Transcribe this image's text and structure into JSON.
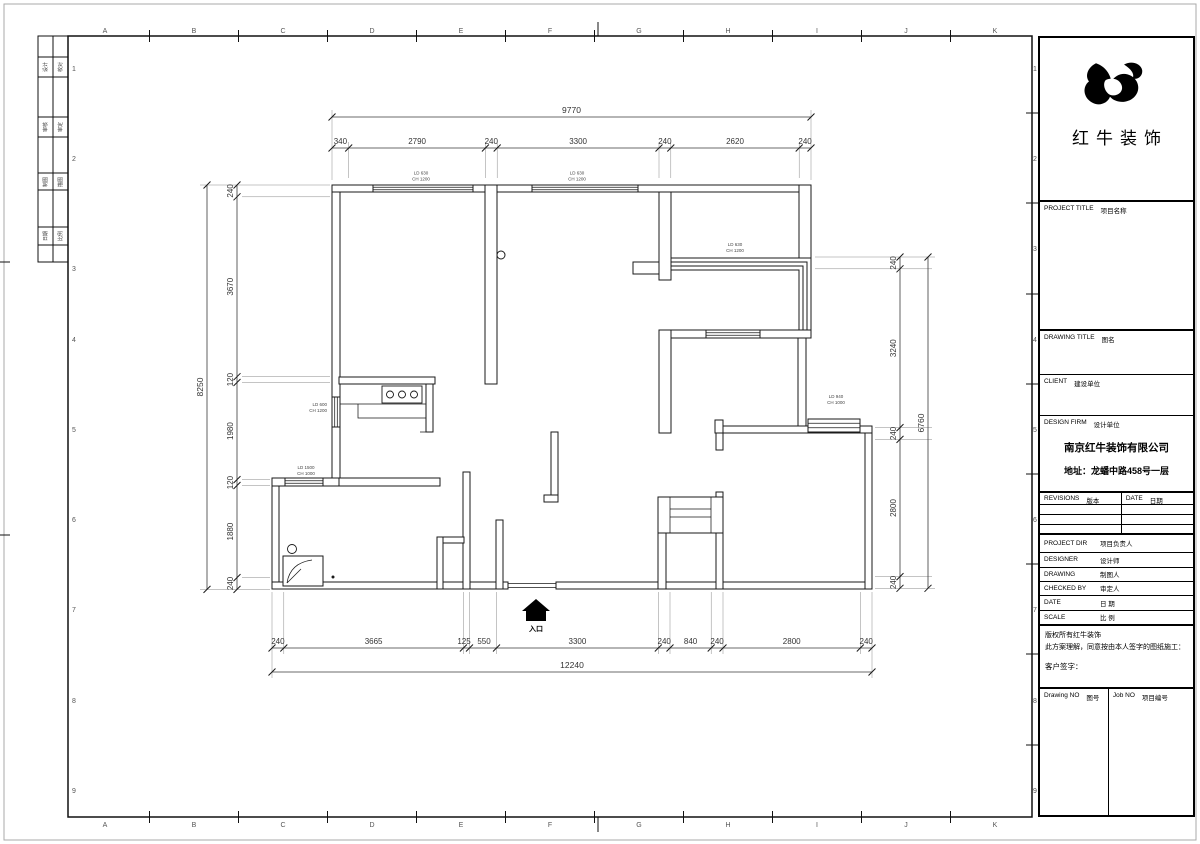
{
  "company": {
    "name": "红牛装饰"
  },
  "grid": {
    "cols": [
      "A",
      "B",
      "C",
      "D",
      "E",
      "F",
      "G",
      "H",
      "I",
      "J",
      "K"
    ],
    "rows": [
      "1",
      "2",
      "3",
      "4",
      "5",
      "6",
      "7",
      "8",
      "9"
    ]
  },
  "signoff": [
    "设计",
    "校对",
    "审核",
    "审定",
    "制图",
    "描图",
    "日期",
    "比例"
  ],
  "plan": {
    "dims": {
      "top": {
        "total": "9770",
        "segments": [
          "340",
          "2790",
          "240",
          "3300",
          "240",
          "2620",
          "240"
        ]
      },
      "bottom": {
        "total": "12240",
        "segments": [
          "240",
          "3665",
          "125",
          "550",
          "3300",
          "240",
          "840",
          "240",
          "2800",
          "240"
        ]
      },
      "left": {
        "total": "8250",
        "segments": [
          "240",
          "3670",
          "120",
          "1980",
          "120",
          "1880",
          "240"
        ]
      },
      "right": {
        "total": "6760",
        "segments": [
          "240",
          "3240",
          "240",
          "2800",
          "240"
        ]
      }
    },
    "windows": [
      {
        "l1": "LD 630",
        "l2": "CH 1200"
      },
      {
        "l1": "LD 630",
        "l2": "CH 1200"
      },
      {
        "l1": "LD 630",
        "l2": "CH 1200"
      },
      {
        "l1": "LD 940",
        "l2": "CH 1000"
      },
      {
        "l1": "LD 600",
        "l2": "CH 1200"
      },
      {
        "l1": "LD 1500",
        "l2": "CH 1000"
      }
    ],
    "entrance_label": "入口"
  },
  "title_block": {
    "project_title": {
      "en": "PROJECT TITLE",
      "zh": "项目名称"
    },
    "drawing_title": {
      "en": "DRAWING TITLE",
      "zh": "图名"
    },
    "client": {
      "en": "CLIENT",
      "zh": "建设单位"
    },
    "design_firm": {
      "en": "DESIGN FIRM",
      "zh": "设计单位"
    },
    "firm_name": "南京红牛装饰有限公司",
    "firm_address": "地址：龙蟠中路458号一层",
    "revisions": {
      "en": "REVISIONS",
      "zh": "版本"
    },
    "rev_date": {
      "en": "DATE",
      "zh": "日期"
    },
    "project_dir": {
      "en": "PROJECT DIR",
      "zh": "项目负责人"
    },
    "designer": {
      "en": "DESIGNER",
      "zh": "设计师"
    },
    "drawing": {
      "en": "DRAWING",
      "zh": "制图人"
    },
    "checked_by": {
      "en": "CHECKED BY",
      "zh": "审定人"
    },
    "date": {
      "en": "DATE",
      "zh": "日  期"
    },
    "scale": {
      "en": "SCALE",
      "zh": "比  例"
    },
    "copyright1": "版权所有红牛装饰",
    "copyright2": "此方案理解，同意按由本人签字的图纸施工：",
    "signature": "客户签字：",
    "drawing_no": {
      "en": "Drawing NO",
      "zh": "图号"
    },
    "job_no": {
      "en": "Job NO",
      "zh": "项目编号"
    }
  }
}
